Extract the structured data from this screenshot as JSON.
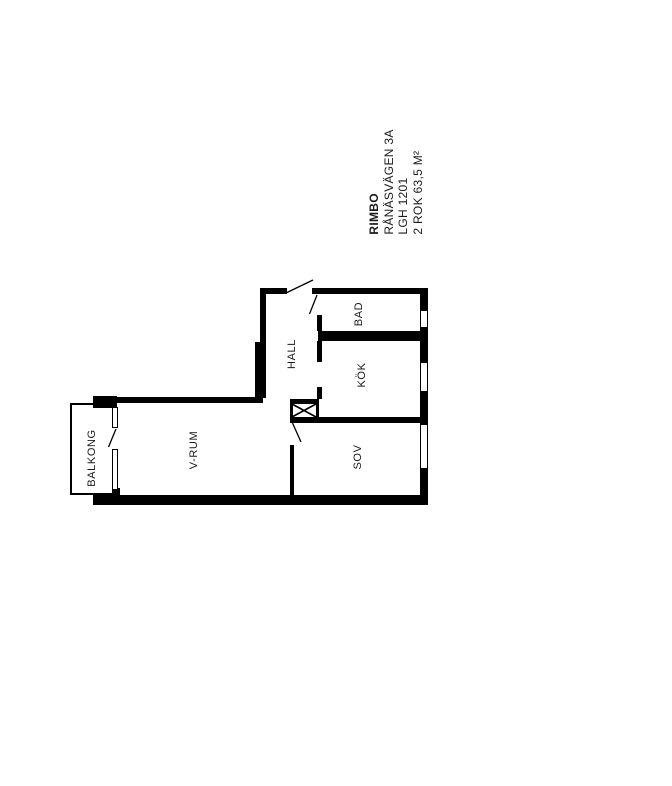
{
  "title_block": {
    "line1": "RIMBO",
    "line2": "RÅNÄSVÄGEN 3A",
    "line3": "LGH 1201",
    "line4": "2 ROK 63,5 M²"
  },
  "rooms": [
    {
      "id": "balkong",
      "label": "BALKONG"
    },
    {
      "id": "v-rum",
      "label": "V-RUM"
    },
    {
      "id": "hall",
      "label": "HALL"
    },
    {
      "id": "bad",
      "label": "BAD"
    },
    {
      "id": "kok",
      "label": "KÖK"
    },
    {
      "id": "sov",
      "label": "SOV"
    }
  ],
  "colors": {
    "wall": "#000000",
    "text": "#1a1a1a",
    "background": "#ffffff"
  }
}
